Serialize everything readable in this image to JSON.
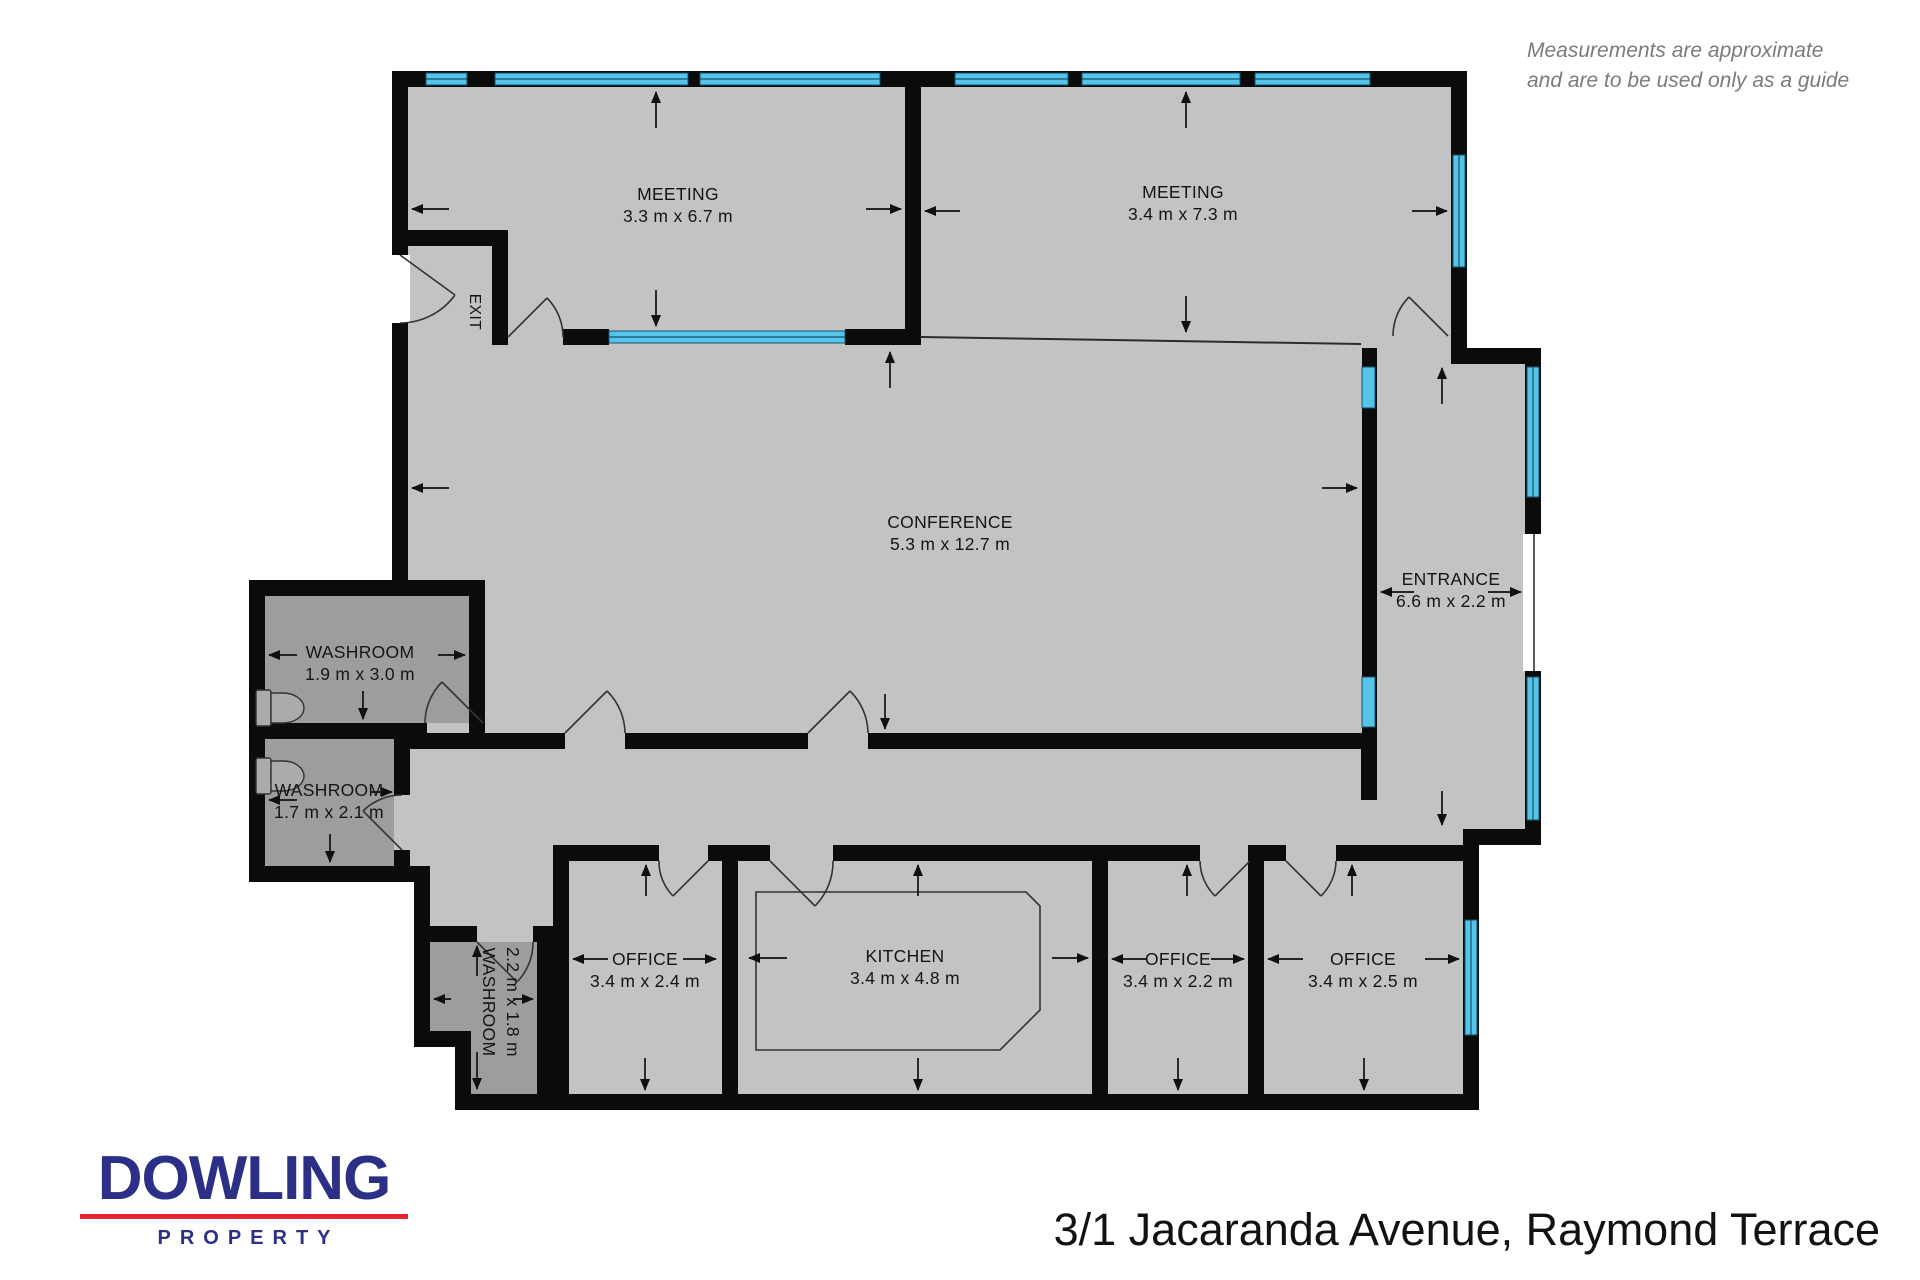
{
  "disclaimer": {
    "line1": "Measurements are approximate",
    "line2": "and are to be used only as a guide"
  },
  "footer": {
    "brand": "DOWLING",
    "brand_sub": "PROPERTY",
    "address": "3/1 Jacaranda Avenue, Raymond Terrace"
  },
  "rooms": {
    "meeting1": {
      "name": "MEETING",
      "dims": "3.3 m x 6.7 m"
    },
    "meeting2": {
      "name": "MEETING",
      "dims": "3.4 m x 7.3 m"
    },
    "conference": {
      "name": "CONFERENCE",
      "dims": "5.3 m x 12.7 m"
    },
    "entrance": {
      "name": "ENTRANCE",
      "dims": "6.6 m x 2.2 m"
    },
    "washroom1": {
      "name": "WASHROOM",
      "dims": "1.9 m x 3.0 m"
    },
    "washroom2": {
      "name": "WASHROOM",
      "dims": "1.7 m x 2.1 m"
    },
    "washroom3": {
      "name": "WASHROOM",
      "dims": "2.2 m x 1.8 m"
    },
    "office1": {
      "name": "OFFICE",
      "dims": "3.4 m x 2.4 m"
    },
    "kitchen": {
      "name": "KITCHEN",
      "dims": "3.4 m x 4.8 m"
    },
    "office2": {
      "name": "OFFICE",
      "dims": "3.4 m x 2.2 m"
    },
    "office3": {
      "name": "OFFICE",
      "dims": "3.4 m x 2.5 m"
    },
    "exit": {
      "name": "EXIT"
    }
  },
  "colors": {
    "wall": "#0b0b0b",
    "floor": "#c3c3c3",
    "washroom": "#9d9d9d",
    "window": "#55c4e8",
    "navy": "#2b2f86",
    "red": "#e62330",
    "muted": "#7b7b7b",
    "line": "#333333"
  }
}
